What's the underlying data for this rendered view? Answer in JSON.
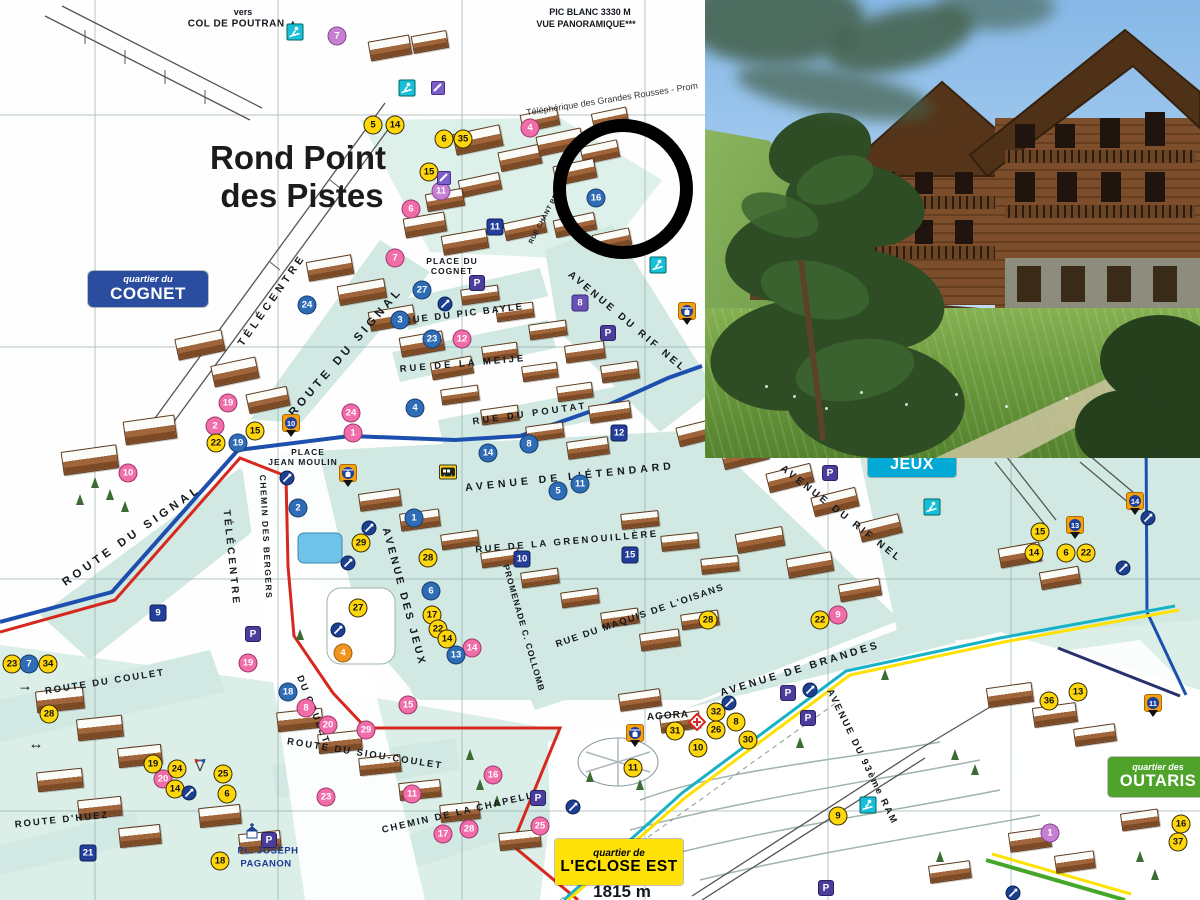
{
  "map": {
    "rond_point": {
      "line1": "Rond Point",
      "line2": "des Pistes"
    },
    "summit": {
      "vers": "vers",
      "col": "COL DE POUTRAN ▲",
      "pic_blanc": "PIC BLANC 3330 M",
      "vue": "VUE PANORAMIQUE***",
      "telepherique": "Téléphérique des Grandes Rousses - Prom",
      "altitude": "1815 m"
    },
    "quartiers": {
      "cognet": {
        "small": "quartier du",
        "big": "COGNET"
      },
      "jeux": {
        "small": "quartier des",
        "big": "JEUX"
      },
      "outaris": {
        "small": "quartier des",
        "big": "OUTARIS"
      },
      "eclose": {
        "small": "quartier de",
        "big": "L'ECLOSE EST"
      }
    },
    "street_labels": [
      {
        "t": "TÉLÉCENTRE",
        "x": 272,
        "y": 300,
        "r": -55,
        "s": 10.5,
        "ls": 4
      },
      {
        "t": "TÉLÉCENTRE",
        "x": 231,
        "y": 558,
        "r": 84,
        "s": 10,
        "ls": 3
      },
      {
        "t": "CHEMIN DES BERGERS",
        "x": 266,
        "y": 537,
        "r": 87,
        "s": 8.5,
        "ls": 1.5
      },
      {
        "t": "ROUTE DU SIGNAL",
        "x": 346,
        "y": 352,
        "r": -49,
        "s": 11.5,
        "ls": 4
      },
      {
        "t": "ROUTE DU SIGNAL",
        "x": 132,
        "y": 536,
        "r": -35,
        "s": 11.5,
        "ls": 4
      },
      {
        "t": "RUE DU PIC BAYLE",
        "x": 464,
        "y": 314,
        "r": -7,
        "s": 9.5,
        "ls": 2
      },
      {
        "t": "RUE DE LA MEIJE",
        "x": 463,
        "y": 364,
        "r": -5,
        "s": 9.5,
        "ls": 3
      },
      {
        "t": "RUE DU POUTAT",
        "x": 530,
        "y": 414,
        "r": -8,
        "s": 9.5,
        "ls": 3
      },
      {
        "t": "AVENUE DU RIF NEL",
        "x": 627,
        "y": 322,
        "r": 40,
        "s": 10,
        "ls": 3
      },
      {
        "t": "AVENUE DU RIF NEL",
        "x": 841,
        "y": 514,
        "r": 38,
        "s": 10,
        "ls": 3
      },
      {
        "t": "AVENUE DE L'ÉTENDARD",
        "x": 570,
        "y": 477,
        "r": -6,
        "s": 10.5,
        "ls": 4
      },
      {
        "t": "RUE DE LA GRENOUILLÈRE",
        "x": 567,
        "y": 542,
        "r": -5,
        "s": 9.5,
        "ls": 2.5
      },
      {
        "t": "AVENUE DES JEUX",
        "x": 404,
        "y": 597,
        "r": 75,
        "s": 10.5,
        "ls": 3
      },
      {
        "t": "PROMENADE C. COLLOMB",
        "x": 524,
        "y": 628,
        "r": 74,
        "s": 8.5,
        "ls": 1
      },
      {
        "t": "RUE DU MAQUIS DE L'OISANS",
        "x": 640,
        "y": 616,
        "r": -19,
        "s": 9.5,
        "ls": 1.5
      },
      {
        "t": "AVENUE DE BRANDES",
        "x": 800,
        "y": 669,
        "r": -17,
        "s": 10.5,
        "ls": 3
      },
      {
        "t": "AVENUE DU 93ème RAM",
        "x": 862,
        "y": 757,
        "r": 64,
        "s": 9.5,
        "ls": 2
      },
      {
        "t": "ROUTE DU COULET",
        "x": 105,
        "y": 682,
        "r": -9,
        "s": 9.5,
        "ls": 2
      },
      {
        "t": "DU COULET",
        "x": 313,
        "y": 710,
        "r": 68,
        "s": 9.5,
        "ls": 2
      },
      {
        "t": "ROUTE DU SIOU-COULET",
        "x": 365,
        "y": 754,
        "r": 9,
        "s": 9.5,
        "ls": 2
      },
      {
        "t": "CHEMIN DE LA CHAPELLE",
        "x": 462,
        "y": 812,
        "r": -13,
        "s": 9.5,
        "ls": 2
      },
      {
        "t": "ROUTE D'HUEZ",
        "x": 62,
        "y": 820,
        "r": -6,
        "s": 9.5,
        "ls": 2
      },
      {
        "t": "RUE CHANT BELLE",
        "x": 547,
        "y": 213,
        "r": -62,
        "s": 6.5,
        "ls": 0.5
      },
      {
        "t": "PLACE DU",
        "x": 452,
        "y": 261,
        "s": 8.5,
        "ls": 1
      },
      {
        "t": "COGNET",
        "x": 452,
        "y": 271,
        "s": 8.5,
        "ls": 1
      },
      {
        "t": "PLACE",
        "x": 308,
        "y": 452,
        "s": 8.5,
        "ls": 1
      },
      {
        "t": "JEAN MOULIN",
        "x": 303,
        "y": 462,
        "s": 8.5,
        "ls": 1
      },
      {
        "t": "PL. JOSEPH",
        "x": 268,
        "y": 851,
        "s": 9.5,
        "ls": 0.5,
        "c": "#1c3a8f"
      },
      {
        "t": "PAGANON",
        "x": 266,
        "y": 864,
        "s": 9.5,
        "ls": 0.5,
        "c": "#1c3a8f"
      },
      {
        "t": "AGORA",
        "x": 668,
        "y": 716,
        "r": -4,
        "s": 10,
        "ls": 1
      },
      {
        "t": "vers",
        "x": 243,
        "y": 12,
        "s": 9,
        "ls": 0
      },
      {
        "t": "COL DE POUTRAN ▲",
        "x": 243,
        "y": 24,
        "s": 10,
        "ls": 0.5
      },
      {
        "t": "PIC BLANC 3330 M",
        "x": 590,
        "y": 12,
        "s": 9,
        "ls": 0
      },
      {
        "t": "VUE PANORAMIQUE***",
        "x": 586,
        "y": 24,
        "s": 9,
        "ls": 0
      },
      {
        "t": "Téléphérique des Grandes Rousses - Prom",
        "x": 612,
        "y": 99,
        "r": -9,
        "s": 9,
        "ls": 0,
        "w": 400,
        "c": "#333333"
      },
      {
        "t": "Rond Point",
        "x": 298,
        "y": 158,
        "s": 33,
        "ls": 0,
        "w": 600,
        "c": "#1b1b1b"
      },
      {
        "t": "des Pistes",
        "x": 302,
        "y": 196,
        "s": 33,
        "ls": 0,
        "w": 600,
        "c": "#1b1b1b"
      },
      {
        "t": "1815 m",
        "x": 622,
        "y": 892,
        "s": 17,
        "ls": 0,
        "w": 600
      }
    ],
    "badges": [
      {
        "k": "pink",
        "n": "4",
        "x": 530,
        "y": 128
      },
      {
        "k": "pink",
        "n": "6",
        "x": 411,
        "y": 209
      },
      {
        "k": "pink",
        "n": "7",
        "x": 395,
        "y": 258
      },
      {
        "k": "pink",
        "n": "12",
        "x": 462,
        "y": 339
      },
      {
        "k": "pink",
        "n": "19",
        "x": 228,
        "y": 403
      },
      {
        "k": "pink",
        "n": "2",
        "x": 215,
        "y": 426
      },
      {
        "k": "pink",
        "n": "24",
        "x": 351,
        "y": 413
      },
      {
        "k": "pink",
        "n": "1",
        "x": 353,
        "y": 433
      },
      {
        "k": "pink",
        "n": "10",
        "x": 128,
        "y": 473
      },
      {
        "k": "pink",
        "n": "14",
        "x": 472,
        "y": 648
      },
      {
        "k": "pink",
        "n": "19",
        "x": 248,
        "y": 663
      },
      {
        "k": "pink",
        "n": "8",
        "x": 306,
        "y": 708
      },
      {
        "k": "pink",
        "n": "20",
        "x": 328,
        "y": 725
      },
      {
        "k": "pink",
        "n": "29",
        "x": 366,
        "y": 730
      },
      {
        "k": "pink",
        "n": "15",
        "x": 408,
        "y": 705
      },
      {
        "k": "pink",
        "n": "16",
        "x": 493,
        "y": 775
      },
      {
        "k": "pink",
        "n": "11",
        "x": 412,
        "y": 794
      },
      {
        "k": "pink",
        "n": "23",
        "x": 326,
        "y": 797
      },
      {
        "k": "pink",
        "n": "17",
        "x": 443,
        "y": 834
      },
      {
        "k": "pink",
        "n": "28",
        "x": 469,
        "y": 829
      },
      {
        "k": "pink",
        "n": "25",
        "x": 540,
        "y": 826
      },
      {
        "k": "pink",
        "n": "20",
        "x": 163,
        "y": 779
      },
      {
        "k": "pink",
        "n": "9",
        "x": 838,
        "y": 615
      },
      {
        "k": "yellow",
        "n": "5",
        "x": 373,
        "y": 125
      },
      {
        "k": "yellow",
        "n": "14",
        "x": 395,
        "y": 125
      },
      {
        "k": "yellow",
        "n": "6",
        "x": 444,
        "y": 139
      },
      {
        "k": "yellow",
        "n": "35",
        "x": 463,
        "y": 139
      },
      {
        "k": "yellow",
        "n": "15",
        "x": 429,
        "y": 172
      },
      {
        "k": "yellow",
        "n": "15",
        "x": 255,
        "y": 431
      },
      {
        "k": "yellow",
        "n": "22",
        "x": 216,
        "y": 443
      },
      {
        "k": "yellow",
        "n": "29",
        "x": 361,
        "y": 543
      },
      {
        "k": "yellow",
        "n": "28",
        "x": 428,
        "y": 558
      },
      {
        "k": "yellow",
        "n": "27",
        "x": 358,
        "y": 608
      },
      {
        "k": "yellow",
        "n": "17",
        "x": 432,
        "y": 615
      },
      {
        "k": "yellow",
        "n": "22",
        "x": 438,
        "y": 629
      },
      {
        "k": "yellow",
        "n": "14",
        "x": 447,
        "y": 639
      },
      {
        "k": "yellow",
        "n": "32",
        "x": 716,
        "y": 712
      },
      {
        "k": "yellow",
        "n": "8",
        "x": 736,
        "y": 722
      },
      {
        "k": "yellow",
        "n": "26",
        "x": 716,
        "y": 730
      },
      {
        "k": "yellow",
        "n": "31",
        "x": 675,
        "y": 731
      },
      {
        "k": "yellow",
        "n": "30",
        "x": 748,
        "y": 740
      },
      {
        "k": "yellow",
        "n": "10",
        "x": 698,
        "y": 748
      },
      {
        "k": "yellow",
        "n": "11",
        "x": 633,
        "y": 768
      },
      {
        "k": "yellow",
        "n": "9",
        "x": 838,
        "y": 816
      },
      {
        "k": "yellow",
        "n": "28",
        "x": 49,
        "y": 714
      },
      {
        "k": "yellow",
        "n": "34",
        "x": 48,
        "y": 664
      },
      {
        "k": "yellow",
        "n": "23",
        "x": 12,
        "y": 664
      },
      {
        "k": "yellow",
        "n": "19",
        "x": 153,
        "y": 764
      },
      {
        "k": "yellow",
        "n": "24",
        "x": 177,
        "y": 769
      },
      {
        "k": "yellow",
        "n": "14",
        "x": 175,
        "y": 789
      },
      {
        "k": "yellow",
        "n": "25",
        "x": 223,
        "y": 774
      },
      {
        "k": "yellow",
        "n": "6",
        "x": 227,
        "y": 794
      },
      {
        "k": "yellow",
        "n": "18",
        "x": 220,
        "y": 861
      },
      {
        "k": "yellow",
        "n": "15",
        "x": 1040,
        "y": 532
      },
      {
        "k": "yellow",
        "n": "14",
        "x": 1034,
        "y": 553
      },
      {
        "k": "yellow",
        "n": "6",
        "x": 1066,
        "y": 553
      },
      {
        "k": "yellow",
        "n": "22",
        "x": 1086,
        "y": 553
      },
      {
        "k": "yellow",
        "n": "36",
        "x": 1049,
        "y": 701
      },
      {
        "k": "yellow",
        "n": "13",
        "x": 1078,
        "y": 692
      },
      {
        "k": "yellow",
        "n": "16",
        "x": 1181,
        "y": 824
      },
      {
        "k": "yellow",
        "n": "37",
        "x": 1178,
        "y": 842
      },
      {
        "k": "yellow",
        "n": "28",
        "x": 708,
        "y": 620
      },
      {
        "k": "yellow",
        "n": "22",
        "x": 820,
        "y": 620
      },
      {
        "k": "blue",
        "n": "24",
        "x": 307,
        "y": 305
      },
      {
        "k": "blue",
        "n": "27",
        "x": 422,
        "y": 290
      },
      {
        "k": "blue",
        "n": "3",
        "x": 400,
        "y": 320
      },
      {
        "k": "blue",
        "n": "23",
        "x": 432,
        "y": 339
      },
      {
        "k": "blue",
        "n": "4",
        "x": 415,
        "y": 408
      },
      {
        "k": "blue",
        "n": "14",
        "x": 488,
        "y": 453
      },
      {
        "k": "blue",
        "n": "8",
        "x": 529,
        "y": 444
      },
      {
        "k": "blue",
        "n": "5",
        "x": 558,
        "y": 491
      },
      {
        "k": "blue",
        "n": "11",
        "x": 580,
        "y": 484
      },
      {
        "k": "blue",
        "n": "1",
        "x": 414,
        "y": 518
      },
      {
        "k": "blue",
        "n": "6",
        "x": 431,
        "y": 591
      },
      {
        "k": "blue",
        "n": "13",
        "x": 456,
        "y": 655
      },
      {
        "k": "blue",
        "n": "2",
        "x": 298,
        "y": 508
      },
      {
        "k": "blue",
        "n": "7",
        "x": 29,
        "y": 664
      },
      {
        "k": "blue",
        "n": "18",
        "x": 288,
        "y": 692
      },
      {
        "k": "blue",
        "n": "19",
        "x": 238,
        "y": 443
      },
      {
        "k": "blue",
        "n": "16",
        "x": 596,
        "y": 198
      },
      {
        "k": "navysq",
        "n": "11",
        "x": 495,
        "y": 227
      },
      {
        "k": "navysq",
        "n": "12",
        "x": 619,
        "y": 433
      },
      {
        "k": "navysq",
        "n": "10",
        "x": 522,
        "y": 559
      },
      {
        "k": "navysq",
        "n": "15",
        "x": 630,
        "y": 555
      },
      {
        "k": "navysq",
        "n": "9",
        "x": 158,
        "y": 613
      },
      {
        "k": "navysq",
        "n": "21",
        "x": 88,
        "y": 853
      },
      {
        "k": "violet",
        "n": "7",
        "x": 337,
        "y": 36
      },
      {
        "k": "violet",
        "n": "11",
        "x": 441,
        "y": 191
      },
      {
        "k": "violet",
        "n": "1",
        "x": 1050,
        "y": 833
      },
      {
        "k": "orange",
        "n": "4",
        "x": 343,
        "y": 653
      },
      {
        "k": "purplesq",
        "n": "8",
        "x": 580,
        "y": 303
      }
    ],
    "icons": [
      {
        "t": "lift",
        "n": "10",
        "x": 291,
        "y": 423
      },
      {
        "t": "lift",
        "n": "13",
        "x": 1075,
        "y": 525
      },
      {
        "t": "lift",
        "n": "14",
        "x": 1135,
        "y": 501
      },
      {
        "t": "lift",
        "n": "11",
        "x": 1153,
        "y": 703
      },
      {
        "t": "lift",
        "x": 348,
        "y": 473
      },
      {
        "t": "lift",
        "x": 635,
        "y": 733
      },
      {
        "t": "lift",
        "x": 687,
        "y": 311
      },
      {
        "t": "p",
        "x": 477,
        "y": 283
      },
      {
        "t": "p",
        "x": 608,
        "y": 333
      },
      {
        "t": "p",
        "x": 830,
        "y": 473
      },
      {
        "t": "p",
        "x": 253,
        "y": 634
      },
      {
        "t": "p",
        "x": 269,
        "y": 840
      },
      {
        "t": "p",
        "x": 788,
        "y": 693
      },
      {
        "t": "p",
        "x": 808,
        "y": 718
      },
      {
        "t": "p",
        "x": 826,
        "y": 888
      },
      {
        "t": "p",
        "x": 538,
        "y": 798
      },
      {
        "t": "info",
        "x": 445,
        "y": 304
      },
      {
        "t": "info",
        "x": 287,
        "y": 478
      },
      {
        "t": "info",
        "x": 369,
        "y": 528
      },
      {
        "t": "info",
        "x": 348,
        "y": 563
      },
      {
        "t": "info",
        "x": 338,
        "y": 630
      },
      {
        "t": "info",
        "x": 189,
        "y": 793
      },
      {
        "t": "info",
        "x": 573,
        "y": 807
      },
      {
        "t": "info",
        "x": 729,
        "y": 703
      },
      {
        "t": "info",
        "x": 810,
        "y": 690
      },
      {
        "t": "info",
        "x": 1148,
        "y": 518
      },
      {
        "t": "info",
        "x": 1123,
        "y": 568
      },
      {
        "t": "info",
        "x": 1013,
        "y": 893
      },
      {
        "t": "ski",
        "x": 295,
        "y": 32
      },
      {
        "t": "ski",
        "x": 407,
        "y": 88
      },
      {
        "t": "ski",
        "x": 658,
        "y": 265
      },
      {
        "t": "ski",
        "x": 932,
        "y": 507
      },
      {
        "t": "ski",
        "x": 868,
        "y": 805
      },
      {
        "t": "purple",
        "x": 438,
        "y": 88
      },
      {
        "t": "purple",
        "x": 444,
        "y": 178
      },
      {
        "t": "church",
        "x": 252,
        "y": 831
      },
      {
        "t": "meet",
        "x": 697,
        "y": 722
      },
      {
        "t": "flags",
        "x": 200,
        "y": 765
      },
      {
        "t": "bus",
        "x": 448,
        "y": 472
      },
      {
        "t": "arrow-r",
        "x": 25,
        "y": 686
      },
      {
        "t": "arrow-lr",
        "x": 36,
        "y": 744
      }
    ],
    "colors": {
      "street_fill": "#cfe8e1",
      "snow": "#ffffff",
      "route_red": "#d6281e",
      "route_blue": "#1d4fae",
      "route_teal": "#18b2c6",
      "route_yellow": "#ffe100",
      "route_green": "#45a629",
      "badge_pink": "#f06daa",
      "badge_yellow": "#ffd60b",
      "badge_blue": "#2e6cb5",
      "quartier_cognet_bg": "#2b4da0",
      "quartier_jeux_bg": "#02a9d4",
      "quartier_outaris_bg": "#4fa32a",
      "quartier_eclose_bg": "#ffe10a",
      "highlight_circle": "#000000"
    }
  }
}
